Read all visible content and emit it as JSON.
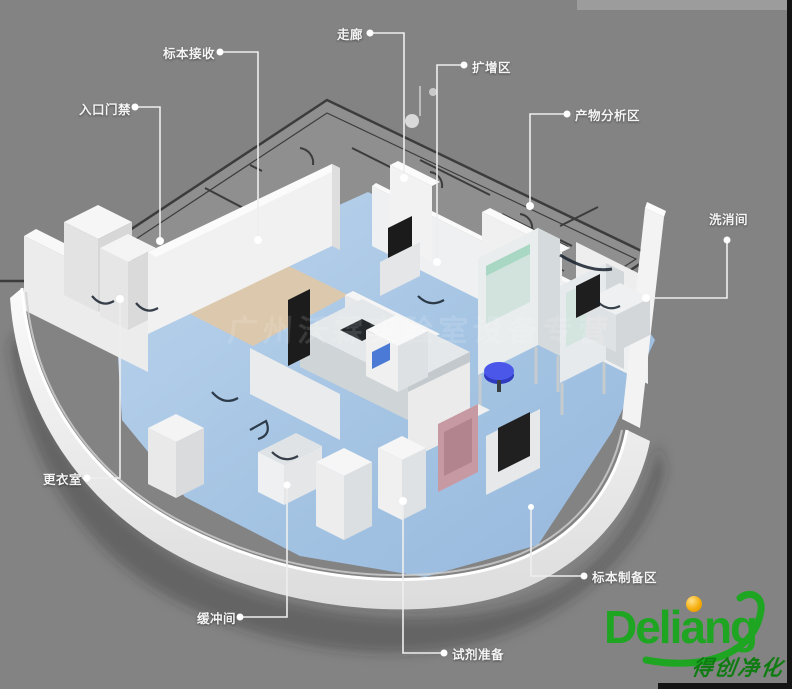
{
  "canvas": {
    "background_color": "#838383",
    "top_strip_color": "#9c9c9c",
    "edge_strip_color": "#141414"
  },
  "labels": {
    "specimen_receiving": "标本接收",
    "entrance_access": "入口门禁",
    "corridor": "走廊",
    "amplification_area": "扩增区",
    "product_analysis_area": "产物分析区",
    "washing_room": "洗消间",
    "changing_room": "更衣室",
    "buffer_room": "缓冲间",
    "reagent_preparation": "试剂准备",
    "specimen_preparation_area": "标本制备区"
  },
  "watermark": {
    "text": "广州沃霖实验室设备专营"
  },
  "logo": {
    "brand": "Deliang",
    "tagline": "得创净化",
    "brand_color": "#1ea622",
    "dot_color": "#f5ae0c"
  }
}
